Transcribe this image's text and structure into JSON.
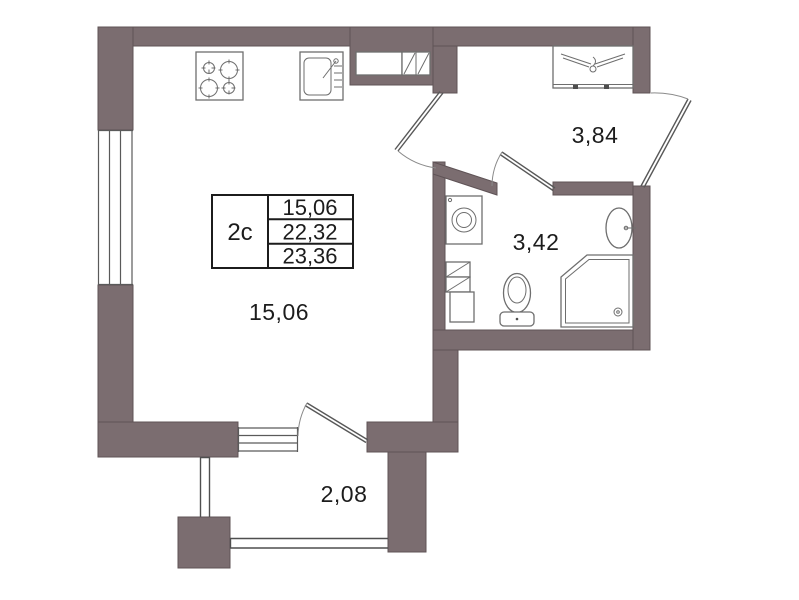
{
  "legend": {
    "unit": "2с",
    "rows": [
      "15,06",
      "22,32",
      "23,36"
    ]
  },
  "rooms": {
    "living": "15,06",
    "hallway": "3,84",
    "bathroom": "3,42",
    "balcony": "2,08"
  },
  "icons": {
    "stove": "stove-icon",
    "sink": "sink-icon",
    "hanger": "hanger-icon",
    "washing_machine": "washing-machine-icon",
    "washbasin": "washbasin-icon",
    "toilet": "toilet-icon",
    "shower": "shower-icon",
    "vent": "vent-hatch-icon"
  },
  "colors": {
    "wall": "#7b6d70",
    "wall_edge": "#5f5356",
    "fixture_line": "#6e6e6e",
    "thin_line": "#4f4f4f",
    "text": "#1c1c1c",
    "background": "#ffffff"
  }
}
